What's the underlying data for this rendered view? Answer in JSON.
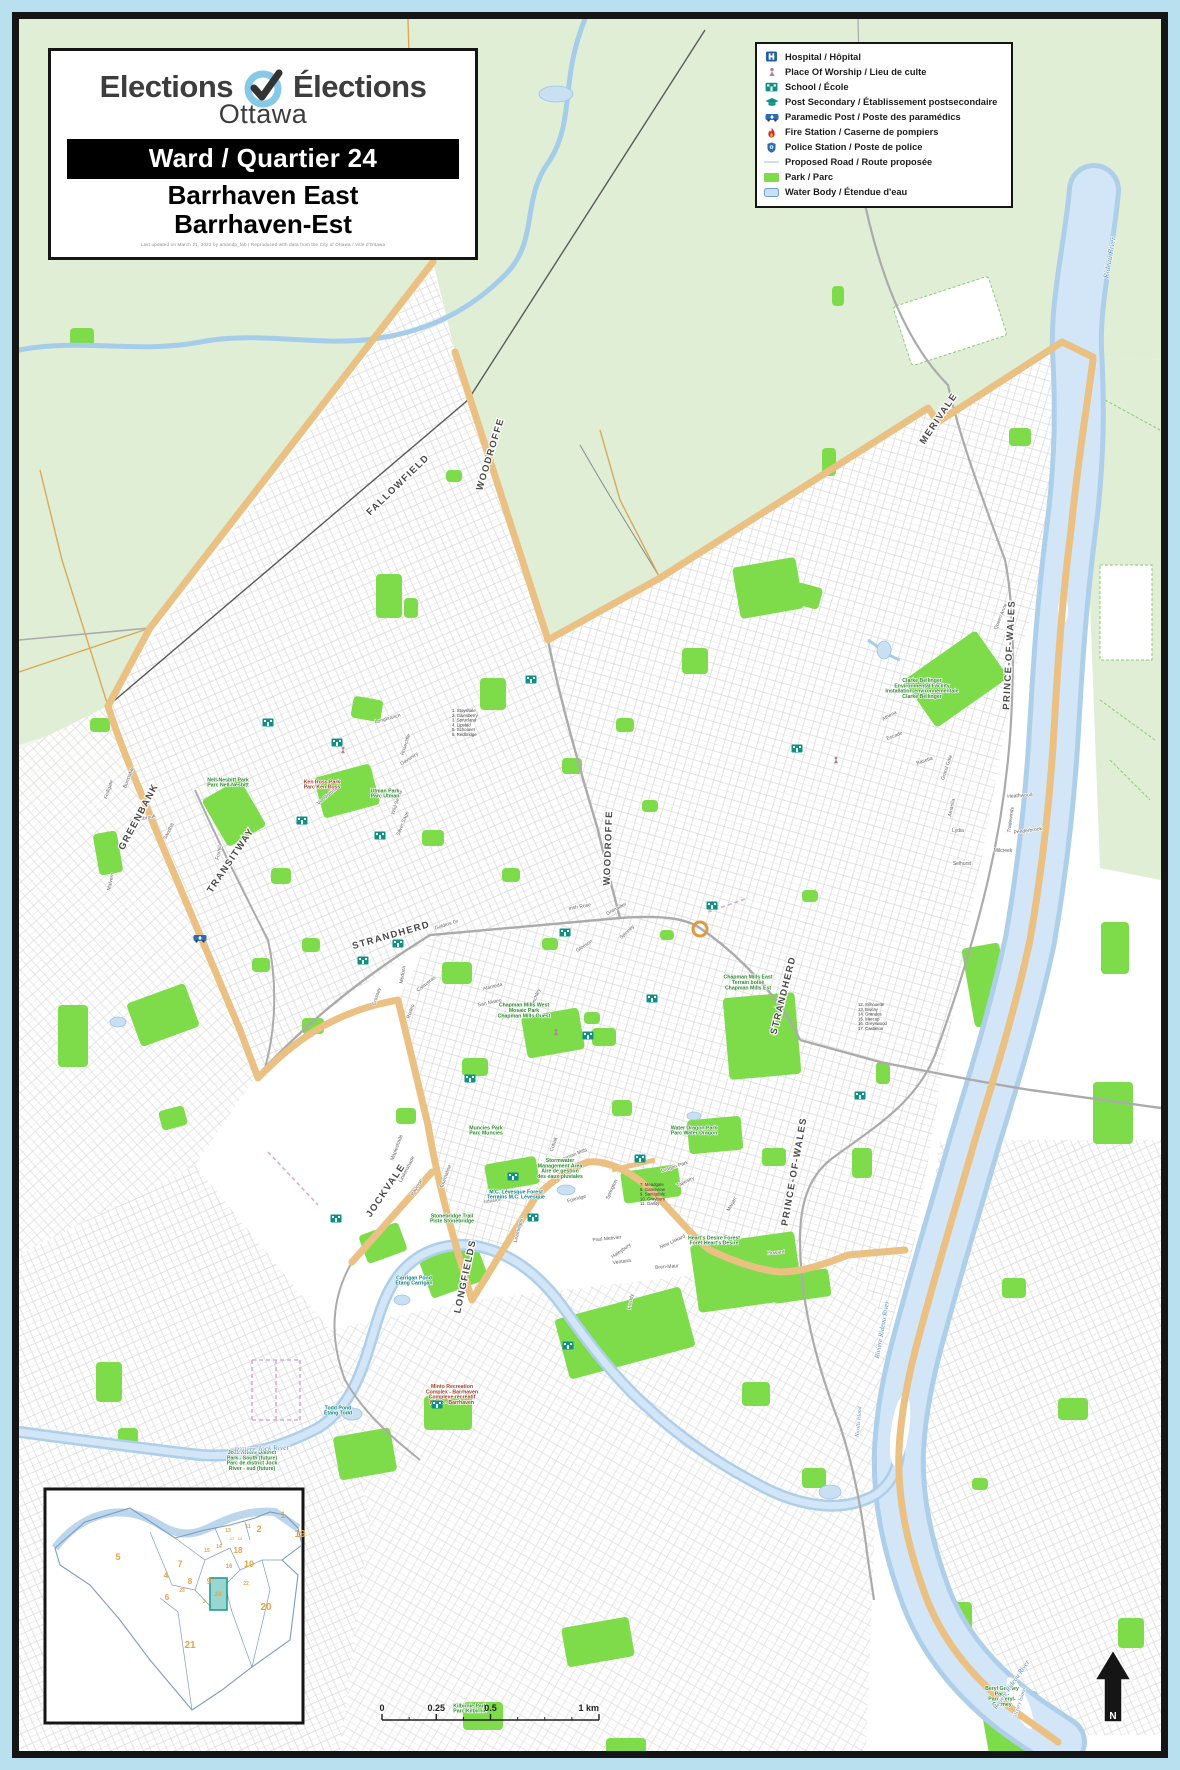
{
  "title_block": {
    "logo_left": "Elections",
    "logo_right": "Élections",
    "logo_sub": "Ottawa",
    "ward_banner": "Ward / Quartier 24",
    "name_en": "Barrhaven East",
    "name_fr": "Barrhaven-Est",
    "attribution": "Last updated on March 21, 2022 by amandp_fab | Reproduced with data from the City of Ottawa / Ville d'Ottawa"
  },
  "legend": {
    "items": [
      {
        "icon": "hospital-icon",
        "label": "Hospital / Hôpital"
      },
      {
        "icon": "worship-icon",
        "label": "Place Of Worship / Lieu de culte"
      },
      {
        "icon": "school-icon",
        "label": "School / École"
      },
      {
        "icon": "postsecondary-icon",
        "label": "Post Secondary / Établissement postsecondaire"
      },
      {
        "icon": "paramedic-icon",
        "label": "Paramedic Post / Poste des paramédics"
      },
      {
        "icon": "fire-icon",
        "label": "Fire Station / Caserne de pompiers"
      },
      {
        "icon": "police-icon",
        "label": "Police Station / Poste de police"
      },
      {
        "icon": "proposed-road-icon",
        "label": "Proposed Road / Route proposée"
      },
      {
        "icon": "park-icon",
        "label": "Park / Parc"
      },
      {
        "icon": "water-icon",
        "label": "Water Body / Étendue d'eau"
      }
    ]
  },
  "colors": {
    "frame_cyan": "#b9e0ef",
    "frame_black": "#151515",
    "rural_green": "#e0eed6",
    "park_green": "#7edc4b",
    "water_fill": "#c9e0f3",
    "water_light": "#dcecf9",
    "boundary_tan": "#eac183",
    "school_teal": "#0d9186",
    "transit_orange": "#e09a3c",
    "ward_number_orange": "#e8a33d",
    "water_text": "#5b8ab8",
    "park_text": "#2e8b2e"
  },
  "map": {
    "road_labels": [
      [
        "GREENBANK",
        141,
        818,
        -62
      ],
      [
        "FALLOWFIELD",
        400,
        487,
        -44
      ],
      [
        "WOODROFFE",
        493,
        455,
        -73
      ],
      [
        "WOODROFFE",
        611,
        848,
        -88
      ],
      [
        "STRANDHERD",
        392,
        938,
        -16
      ],
      [
        "STRANDHERD",
        786,
        996,
        -76
      ],
      [
        "LONGFIELDS",
        468,
        1277,
        -78
      ],
      [
        "JOCKVALE",
        388,
        1192,
        -56
      ],
      [
        "PRINCE-OF-WALES",
        1012,
        655,
        -87
      ],
      [
        "PRINCE-OF-WALES",
        797,
        1172,
        -80
      ],
      [
        "MERIVALE",
        941,
        420,
        -56
      ],
      [
        "TRANSITWAY",
        233,
        862,
        -56,
        "#e09a3c"
      ]
    ],
    "water_labels": [
      [
        "Rideau River",
        1112,
        258,
        -80,
        8
      ],
      [
        "Rivière Rideau River",
        884,
        1330,
        -80,
        7
      ],
      [
        "Rivière Rideau River",
        1013,
        1686,
        -55,
        7
      ],
      [
        "Rivière Jock River",
        262,
        1451,
        -3,
        7.5
      ],
      [
        "Nicolls Island",
        860,
        1422,
        -85,
        5.5
      ],
      [
        "Victory Island",
        1021,
        1703,
        -72,
        5.5
      ]
    ],
    "park_labels": [
      [
        "Ken Ross Park|Parc Ken Ross",
        322,
        786,
        "#a04028"
      ],
      [
        "Utman Park|Parc Utman",
        385,
        795
      ],
      [
        "Nell-Nesbitt Park|Parc Nell-Nesbitt",
        228,
        784
      ],
      [
        "Chapman Mills West|Mosaic Park|Chapman Mills Ouest",
        524,
        1012
      ],
      [
        "Chapman Mills East|Terrain boisé|Chapman Mills Est",
        748,
        984
      ],
      [
        "Water Dragon Park|Parc Water Dragon",
        694,
        1132
      ],
      [
        "Heart's Desire Forest|Forêt Heart's Desire",
        714,
        1242
      ],
      [
        "Clarke Bellinger|Environmental Facility|Installation environnementale|Clarke Bellinger",
        922,
        690
      ],
      [
        "M.C. Lévesque Forest|Terrains M.C. Lévesque",
        516,
        1196,
        "#0e8080"
      ],
      [
        "Stormwater|Management Area|Aire de gestion|des eaux pluviales",
        560,
        1170
      ],
      [
        "Stonebridge Trail|Piste Stonebridge",
        452,
        1220
      ],
      [
        "Jock Rivers District|Park - South (future)|Parc de district Jock|River - sud (future)",
        252,
        1462
      ],
      [
        "Carrigan Pond|Étang Carrigan",
        414,
        1282,
        "#0e8080"
      ],
      [
        "Todd Pond|Étang Todd",
        338,
        1412,
        "#0e8080"
      ],
      [
        "Minto Recreation|Complex - Barrhaven|Complexe récréatif|Minto - Barrhaven",
        452,
        1396,
        "#a04028"
      ],
      [
        "Beryl Gaffney|Park -|Parc Beryl-|Gaffney",
        1002,
        1698
      ],
      [
        "Muncies Park|Parc Muncies",
        486,
        1132
      ],
      [
        "Kilbirnie Park|Parc Kilbirnie",
        470,
        1710
      ]
    ],
    "street_labels": [
      [
        "Golders Gr",
        447,
        926,
        -18
      ],
      [
        "Calaveras",
        427,
        985,
        -38
      ],
      [
        "Alameda",
        493,
        988,
        -14
      ],
      [
        "San Mateo",
        490,
        1004,
        -12
      ],
      [
        "Finchley",
        537,
        998,
        -68
      ],
      [
        "Gleeson",
        585,
        947,
        -33
      ],
      [
        "Spinney",
        628,
        933,
        -44
      ],
      [
        "Grenadier",
        617,
        910,
        -28
      ],
      [
        "Medoza",
        404,
        975,
        -80
      ],
      [
        "Crossey",
        378,
        997,
        -72
      ],
      [
        "Rodeo",
        412,
        1012,
        -70
      ],
      [
        "Via Mattino",
        328,
        797,
        -40
      ],
      [
        "Daventry",
        410,
        760,
        -33
      ],
      [
        "Rosecliffe",
        407,
        745,
        -72
      ],
      [
        "Wild Senna",
        398,
        803,
        -72
      ],
      [
        "Silver Sage",
        404,
        824,
        -68
      ],
      [
        "Fedigate",
        110,
        790,
        -72
      ],
      [
        "Bunstable",
        130,
        778,
        -68
      ],
      [
        "Knollsbrook",
        143,
        820,
        -12
      ],
      [
        "Sandhill",
        170,
        832,
        -62
      ],
      [
        "Foxhill",
        220,
        853,
        -78
      ],
      [
        "Malvern",
        112,
        882,
        -78
      ],
      [
        "Queen Anne",
        1002,
        617,
        -68
      ],
      [
        "Athena",
        890,
        717,
        -28
      ],
      [
        "Escade",
        895,
        737,
        -22
      ],
      [
        "Basetta",
        925,
        762,
        -18
      ],
      [
        "Grand Gala",
        948,
        768,
        -72
      ],
      [
        "Amarilla",
        953,
        808,
        -78
      ],
      [
        "Lydia",
        958,
        832,
        0
      ],
      [
        "Selhurst",
        962,
        865,
        0
      ],
      [
        "Milcreek",
        1003,
        852,
        0
      ],
      [
        "Tradewinds",
        1012,
        820,
        -82
      ],
      [
        "Penderbrook",
        1028,
        832,
        -8
      ],
      [
        "Heathwood",
        1020,
        797,
        -4
      ],
      [
        "Chapman Mills",
        572,
        1157,
        -22
      ],
      [
        "Dragon Park",
        675,
        1168,
        -18
      ],
      [
        "Tapestry",
        686,
        1183,
        -25
      ],
      [
        "Ventana",
        622,
        1263,
        -8
      ],
      [
        "Paul Metivier",
        607,
        1240,
        -6
      ],
      [
        "Haleybury",
        622,
        1252,
        -35
      ],
      [
        "New Liskard",
        673,
        1243,
        -25
      ],
      [
        "Marjan",
        733,
        1205,
        -60
      ],
      [
        "Coley",
        722,
        1244,
        -8
      ],
      [
        "Howard",
        776,
        1254,
        -5
      ],
      [
        "Bren-Maur",
        667,
        1268,
        -4
      ],
      [
        "Lindenshade",
        408,
        1170,
        -62
      ],
      [
        "Bayrose",
        418,
        1188,
        -60
      ],
      [
        "Tourmaline",
        447,
        1177,
        -70
      ],
      [
        "Infusion",
        493,
        1202,
        -10
      ],
      [
        "Foxridge",
        577,
        1200,
        -15
      ],
      [
        "Springton",
        613,
        1190,
        -65
      ],
      [
        "Leamington",
        520,
        1230,
        -75
      ],
      [
        "Mapleshade",
        398,
        1148,
        -70
      ],
      [
        "Freddy",
        632,
        1302,
        -80
      ],
      [
        "Cobalt",
        555,
        1145,
        -70
      ],
      [
        "Irish Rose",
        580,
        908,
        -10
      ],
      [
        "Longbranch",
        388,
        720,
        -15
      ]
    ],
    "index_lists": [
      {
        "x": 452,
        "y": 712,
        "lines": [
          "1. Stoyshale",
          "2. Gainsberry",
          "3. Sprucland",
          "4. Lipstad",
          "5. Schooner",
          "6. Redbridge"
        ]
      },
      {
        "x": 640,
        "y": 1186,
        "lines": [
          "7. Meadgate",
          "8. Gatesview",
          "9. Santigdale",
          "10. Grayburn",
          "11. Garlity"
        ]
      },
      {
        "x": 858,
        "y": 1006,
        "lines": [
          "12. Silhouette",
          "13. Biscay",
          "14. Grandes",
          "15. Marcup",
          "16. Greyswood",
          "17. Castleton"
        ]
      }
    ],
    "parks": [
      [
        318,
        770,
        58,
        42,
        -15
      ],
      [
        352,
        698,
        30,
        22,
        10
      ],
      [
        376,
        574,
        26,
        44,
        0
      ],
      [
        480,
        678,
        26,
        32,
        0
      ],
      [
        682,
        648,
        26,
        26,
        0
      ],
      [
        736,
        562,
        64,
        52,
        -10
      ],
      [
        795,
        585,
        26,
        22,
        15
      ],
      [
        132,
        992,
        62,
        46,
        -20
      ],
      [
        58,
        1005,
        30,
        62,
        0
      ],
      [
        96,
        832,
        24,
        42,
        -10
      ],
      [
        212,
        786,
        44,
        54,
        -30
      ],
      [
        442,
        962,
        30,
        22,
        0
      ],
      [
        524,
        1012,
        58,
        42,
        -10
      ],
      [
        592,
        1028,
        24,
        18,
        0
      ],
      [
        726,
        995,
        72,
        82,
        -5
      ],
      [
        912,
        650,
        88,
        58,
        -35
      ],
      [
        968,
        945,
        38,
        80,
        -10
      ],
      [
        1009,
        428,
        22,
        18,
        0
      ],
      [
        822,
        448,
        14,
        28,
        0
      ],
      [
        694,
        1238,
        105,
        68,
        -8
      ],
      [
        560,
        1302,
        130,
        62,
        -15
      ],
      [
        424,
        1250,
        60,
        40,
        -20
      ],
      [
        362,
        1228,
        42,
        30,
        -20
      ],
      [
        486,
        1160,
        52,
        28,
        -10
      ],
      [
        622,
        1168,
        58,
        32,
        -8
      ],
      [
        772,
        1272,
        58,
        28,
        -8
      ],
      [
        336,
        1432,
        58,
        44,
        -10
      ],
      [
        424,
        1396,
        48,
        34,
        0
      ],
      [
        564,
        1622,
        68,
        40,
        -10
      ],
      [
        463,
        1702,
        40,
        28,
        0
      ],
      [
        606,
        1738,
        40,
        18,
        0
      ],
      [
        742,
        1382,
        28,
        24,
        0
      ],
      [
        802,
        1468,
        24,
        20,
        0
      ],
      [
        986,
        1695,
        58,
        78,
        -10
      ],
      [
        944,
        1602,
        28,
        40,
        0
      ],
      [
        1093,
        1082,
        40,
        62,
        0
      ],
      [
        1101,
        922,
        28,
        52,
        0
      ],
      [
        271,
        868,
        20,
        16,
        0
      ],
      [
        302,
        938,
        18,
        14,
        0
      ],
      [
        422,
        830,
        22,
        16,
        0
      ],
      [
        502,
        868,
        18,
        14,
        0
      ],
      [
        562,
        758,
        20,
        16,
        0
      ],
      [
        616,
        718,
        18,
        14,
        0
      ],
      [
        642,
        800,
        16,
        12,
        0
      ],
      [
        542,
        938,
        16,
        12,
        0
      ],
      [
        462,
        1058,
        26,
        18,
        0
      ],
      [
        396,
        1108,
        20,
        16,
        0
      ],
      [
        302,
        1018,
        22,
        16,
        0
      ],
      [
        252,
        958,
        18,
        14,
        0
      ],
      [
        70,
        328,
        24,
        18,
        0
      ],
      [
        832,
        286,
        12,
        20,
        0
      ],
      [
        688,
        1118,
        54,
        34,
        -5
      ],
      [
        612,
        1100,
        20,
        16,
        0
      ],
      [
        762,
        1148,
        24,
        18,
        0
      ],
      [
        852,
        1148,
        20,
        30,
        0
      ],
      [
        1002,
        1278,
        24,
        20,
        0
      ],
      [
        1058,
        1398,
        30,
        22,
        0
      ],
      [
        972,
        1478,
        16,
        12,
        0
      ],
      [
        1118,
        1618,
        26,
        30,
        0
      ],
      [
        404,
        598,
        14,
        20,
        0
      ],
      [
        90,
        718,
        20,
        14,
        0
      ],
      [
        160,
        1108,
        26,
        20,
        -15
      ],
      [
        96,
        1362,
        26,
        40,
        0
      ],
      [
        118,
        1428,
        20,
        16,
        0
      ],
      [
        584,
        1012,
        16,
        12,
        0
      ],
      [
        660,
        930,
        14,
        10,
        0
      ],
      [
        802,
        890,
        16,
        12,
        0
      ],
      [
        876,
        1062,
        14,
        22,
        0
      ],
      [
        446,
        470,
        16,
        12,
        0
      ]
    ],
    "ponds": [
      [
        556,
        94,
        17,
        8
      ],
      [
        352,
        1414,
        10,
        6
      ],
      [
        402,
        1300,
        8,
        5
      ],
      [
        566,
        1190,
        9,
        5
      ],
      [
        694,
        1116,
        7,
        4
      ],
      [
        830,
        1492,
        11,
        7
      ],
      [
        118,
        1022,
        8,
        5
      ],
      [
        884,
        650,
        7,
        9
      ]
    ],
    "schools": [
      [
        268,
        722
      ],
      [
        337,
        742
      ],
      [
        302,
        820
      ],
      [
        380,
        835
      ],
      [
        531,
        679
      ],
      [
        398,
        943
      ],
      [
        363,
        960
      ],
      [
        565,
        932
      ],
      [
        470,
        1078
      ],
      [
        336,
        1218
      ],
      [
        652,
        998
      ],
      [
        797,
        748
      ],
      [
        588,
        1035
      ],
      [
        568,
        1345
      ],
      [
        437,
        1404
      ],
      [
        640,
        1158
      ],
      [
        513,
        1176
      ],
      [
        533,
        1217
      ],
      [
        712,
        905
      ],
      [
        860,
        1095
      ]
    ],
    "worship": [
      [
        343,
        750
      ],
      [
        556,
        1032
      ],
      [
        836,
        760
      ]
    ],
    "paramedic": [
      [
        200,
        938
      ]
    ]
  },
  "inset": {
    "ward_numbers": [
      [
        "5",
        118,
        1560,
        9
      ],
      [
        "7",
        180,
        1567,
        9
      ],
      [
        "4",
        166,
        1578,
        8
      ],
      [
        "8",
        190,
        1584,
        8
      ],
      [
        "9",
        209,
        1584,
        8
      ],
      [
        "6",
        167,
        1600,
        8
      ],
      [
        "23",
        182,
        1592,
        5
      ],
      [
        "10",
        249,
        1567,
        9
      ],
      [
        "16",
        229,
        1568,
        6
      ],
      [
        "18",
        238,
        1553,
        8
      ],
      [
        "2",
        259,
        1532,
        9
      ],
      [
        "1",
        283,
        1518,
        9
      ],
      [
        "19",
        300,
        1537,
        10
      ],
      [
        "20",
        266,
        1610,
        10
      ],
      [
        "21",
        190,
        1648,
        10
      ],
      [
        "22",
        246,
        1585,
        5
      ],
      [
        "24",
        218,
        1596,
        6,
        "#b5651d"
      ],
      [
        "15",
        207,
        1552,
        5
      ],
      [
        "14",
        219,
        1548,
        5
      ],
      [
        "13",
        228,
        1532,
        5
      ],
      [
        "11",
        248,
        1528,
        5
      ],
      [
        "12",
        240,
        1540,
        4
      ],
      [
        "3",
        204,
        1603,
        5
      ],
      [
        "17",
        232,
        1540,
        4
      ]
    ]
  },
  "scalebar": {
    "ticks": [
      {
        "label": "0",
        "f": 0
      },
      {
        "label": "0.25",
        "f": 0.25
      },
      {
        "label": "0.5",
        "f": 0.5
      },
      {
        "label": "1 km",
        "f": 1
      }
    ]
  },
  "north_label": "N"
}
